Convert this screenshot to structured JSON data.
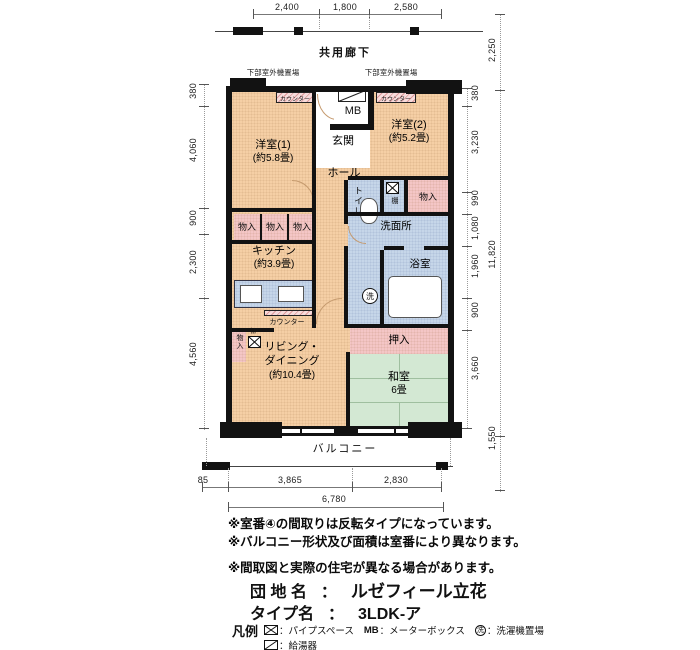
{
  "dims": {
    "top": [
      "2,400",
      "1,800",
      "2,580"
    ],
    "left": [
      "380",
      "4,060",
      "900",
      "2,300",
      "4,560"
    ],
    "right_inner": [
      "380",
      "3,230",
      "990",
      "1,080",
      "1,960",
      "900",
      "3,660"
    ],
    "right_outer": {
      "corridor_depth": "2,250",
      "total_height": "11,820",
      "balcony_depth": "1,550"
    },
    "bottom": [
      "85",
      "3,865",
      "2,830"
    ],
    "bottom_total": "6,780"
  },
  "labels": {
    "corridor": "共用廊下",
    "outdoor_unit": "下部室外機置場",
    "counter": "カウンター",
    "mb": "MB",
    "balcony": "バルコニー",
    "shelf": "棚",
    "washer": "洗"
  },
  "rooms": {
    "west1": {
      "name": "洋室(1)",
      "size": "(約5.8畳)"
    },
    "west2": {
      "name": "洋室(2)",
      "size": "(約5.2畳)"
    },
    "entrance": "玄関",
    "hall": "ホール",
    "toilet": "トイレ",
    "closet": "物入",
    "washroom": "洗面所",
    "bathroom": "浴室",
    "kitchen": {
      "name": "キッチン",
      "size": "(約3.9畳)"
    },
    "living": {
      "line1": "リビング・",
      "line2": "ダイニング",
      "size": "(約10.4畳)"
    },
    "oshiire": "押入",
    "japanese": {
      "name": "和室",
      "size": "6畳"
    }
  },
  "notes": [
    "※室番④の間取りは反転タイプになっています。",
    "※バルコニー形状及び面積は室番により異なります。",
    "※間取図と実際の住宅が異なる場合があります。"
  ],
  "title": {
    "estate_label": "団 地 名",
    "separator": "：",
    "estate_value": "ルゼフィール立花",
    "type_label": "タイプ名",
    "type_value": "3LDK-ア"
  },
  "legend": {
    "heading": "凡例",
    "pipe_space": "：パイプスペース",
    "meter_box_symbol": "MB",
    "meter_box": "：メーターボックス",
    "washer_symbol": "洗",
    "washer_place": "：洗濯機置場",
    "boiler": "：給湯器"
  },
  "colors": {
    "room_peach": "#f5cfa5",
    "closet_pink": "#f4c6c6",
    "wet_blue": "#c6d6e9",
    "tatami_green": "#d3e8d3",
    "wall": "#121212"
  }
}
